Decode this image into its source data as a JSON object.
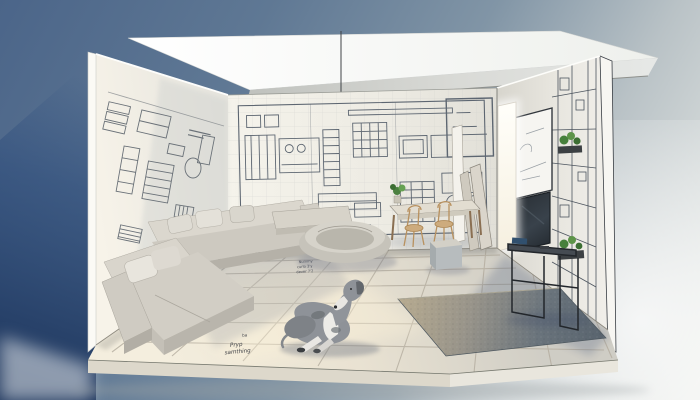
{
  "meta": {
    "domain": "natural-image",
    "description": "Photorealistic 3D cutaway diorama of a living room whose walls are covered in architectural blueprint drawings; a grey-and-white Great Dane lies on the large-tiled floor among modern light-grey furniture, with a bright doorway and black wireframe console on the right."
  },
  "scene": {
    "palette": {
      "sky_top_left": "#4b6589",
      "sky_mid": "#8195a6",
      "backdrop_light": "#eceeea",
      "exterior_shadow": "#244780",
      "ceiling_white": "#fbfbf8",
      "wall_cream": "#f1efe7",
      "blueprint_ink": "#5d6671",
      "floor_tile": "#eee7d7",
      "tile_grout": "#b3ac9e",
      "sofa_fabric": "#d2cec5",
      "rug_dark": "#67727b",
      "rug_lit": "#b7ab90",
      "dog_coat": "#8e9298",
      "dog_white": "#ecebe7",
      "wood": "#c8a87e",
      "console_metal": "#22262b",
      "plant_green": "#47803c",
      "doorway_glow": "#fffdf4"
    },
    "objects": {
      "ceiling": "floating white ceiling slab",
      "left_wall": "blueprint elevation wall",
      "back_wall": "blueprint plan wall",
      "right_wall": "sketch and grid wall",
      "doorway": "bright open doorway",
      "pendant": "ceiling pendant wire",
      "sofa": "L-shaped light grey sectional sofa",
      "pouf": "round pouf dog bed",
      "bench": "low upholstered bench",
      "ottoman": "cube ottoman",
      "desk": "wooden work desk",
      "chairs": "two wooden chairs",
      "desk_plant": "potted plant on desk",
      "panels": "boards leaning against wall",
      "whiteboard": "framed sketch board",
      "tv": "wall-mounted TV",
      "console": "black metal console table",
      "books": "books on console",
      "shelf_plants": "small plants on wall shelves",
      "rug": "grey textured area rug",
      "dog": "Great Dane lying on floor",
      "floor": "large-format tiled floor",
      "plinth": "model base plinth"
    },
    "annotations": {
      "floor_note_a_mark": "ba",
      "floor_note_a_line1": "Pryp",
      "floor_note_a_line2": "samthing",
      "floor_note_b_line1": "Nummy",
      "floor_note_b_line2": "curlo 3'y",
      "floor_note_b_line3": "dever 7'2"
    }
  }
}
